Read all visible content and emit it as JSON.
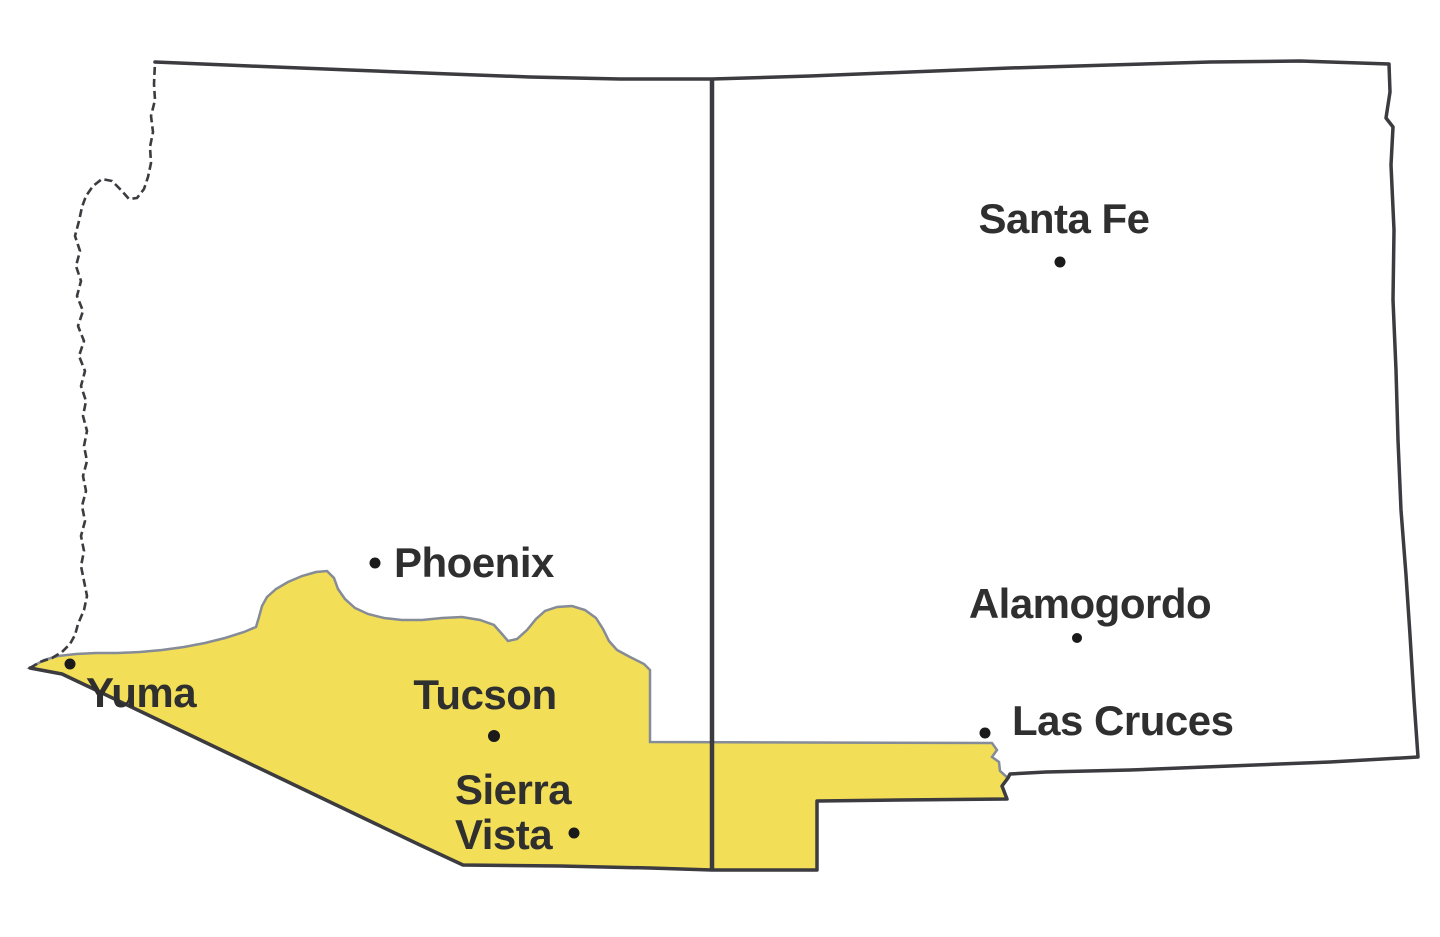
{
  "map": {
    "description_colors": {
      "background": "#FFFFFF",
      "state_border": "#3B3B40",
      "river_border": "#3B3B40",
      "text": "#2F2F2F",
      "dot": "#1A1A1A"
    },
    "highlight_region": {
      "fill": "#F3DF57",
      "outline": "#858B97"
    },
    "cities": [
      {
        "id": "santa-fe",
        "name": "Santa Fe"
      },
      {
        "id": "phoenix",
        "name": "Phoenix"
      },
      {
        "id": "tucson",
        "name": "Tucson"
      },
      {
        "id": "sierra-vista",
        "name": "Sierra Vista",
        "lines": [
          "Sierra",
          "Vista"
        ]
      },
      {
        "id": "yuma",
        "name": "Yuma"
      },
      {
        "id": "alamogordo",
        "name": "Alamogordo"
      },
      {
        "id": "las-cruces",
        "name": "Las Cruces"
      }
    ]
  }
}
